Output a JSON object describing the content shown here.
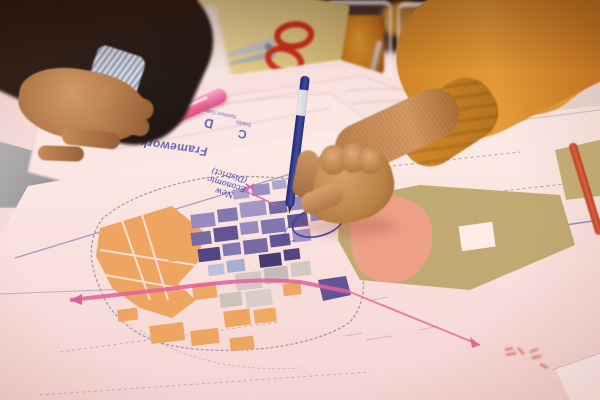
{
  "scene": {
    "type": "photograph",
    "setting": "urban-planning workshop table, close-up, shallow depth of field",
    "description": "Two participants lean over large colour-zoned masterplan map sheets. A hand in a mustard sweater circles a site with a blue ballpoint pen next to a handwritten note, while a suited participant's hand rests beside a pink highlighter. Red-handled scissors on a manila folder, a glass of tea, an empty glass and a red pencil lie around the sheets."
  },
  "map_sheets": {
    "framework_label": "Framework",
    "sheet_d": {
      "letter": "D",
      "title": "Northern Gateway"
    },
    "sheet_c": {
      "letter": "C",
      "title": "Saadia"
    },
    "handwritten_note": {
      "line1": "New",
      "line2": "Economic",
      "line3": "(District)",
      "ink_color": "#2d35a8"
    },
    "zones": [
      {
        "name": "orange mixed-use blocks",
        "color": "#eda55e"
      },
      {
        "name": "lavender residential grid",
        "color": "#8f89c2"
      },
      {
        "name": "dark purple blocks",
        "color": "#473f82"
      },
      {
        "name": "grey blocks",
        "color": "#cfc9c6"
      },
      {
        "name": "salmon development area",
        "color": "#ec9f86"
      },
      {
        "name": "khaki existing fabric",
        "color": "#bcab70"
      },
      {
        "name": "magenta road corridor",
        "color": "#e05a9b"
      },
      {
        "name": "blue pen circle annotation",
        "color": "#3136a0"
      },
      {
        "name": "red stamp marks",
        "color": "#d2452f"
      }
    ]
  },
  "objects": [
    {
      "name": "blue ballpoint pen",
      "note": "held by hand in mustard sweater, drawing a circle"
    },
    {
      "name": "pink highlighter"
    },
    {
      "name": "red-handled scissors on manila folder"
    },
    {
      "name": "glass of amber tea"
    },
    {
      "name": "empty glass"
    },
    {
      "name": "red pencil"
    },
    {
      "name": "dark suit sleeve with striped shirt cuff"
    },
    {
      "name": "grey table surface"
    }
  ],
  "palette": {
    "paper": "#f8e6e2",
    "paper_shadow": "#eccfce",
    "background_dark": "#160b07",
    "sweater_mustard": "#d08420",
    "skin": "#c08a57",
    "table_grey": "#a7abad",
    "pen_blue": "#27348f",
    "highlighter_pink": "#ef5f97",
    "scissors_red": "#c82818",
    "tea_amber": "#c57a1b",
    "pencil_red": "#d24a2c",
    "label_blue": "#3d4cae"
  }
}
